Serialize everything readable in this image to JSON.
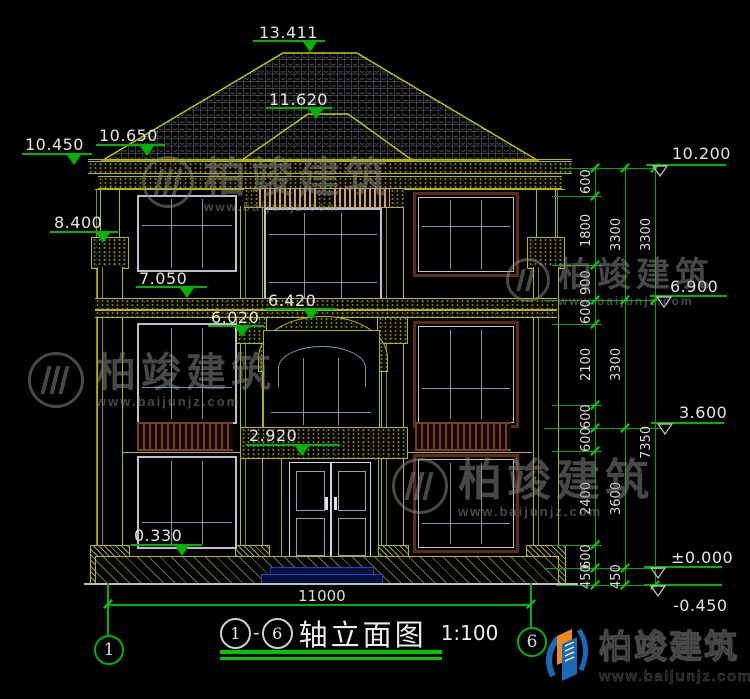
{
  "drawing": {
    "axis_from": "1",
    "axis_to": "6",
    "dash": "-",
    "title_text": "轴立面图",
    "scale": "1:100"
  },
  "axes": {
    "left": "1",
    "right": "6"
  },
  "dimensions": {
    "overall_width": "11000",
    "chain_inner": [
      "600",
      "1800",
      "900",
      "600",
      "2100",
      "600",
      "600",
      "2400",
      "600",
      "450"
    ],
    "chain_mid": [
      "3300",
      "3300",
      "3600",
      "450"
    ],
    "chain_outer": [
      "3300",
      "7350"
    ]
  },
  "elevations": {
    "ridge": "13.411",
    "porch_ridge": "11.620",
    "eave_upper": "10.650",
    "eave_left": "10.450",
    "pilaster_top": "8.400",
    "floor3_sill": "7.050",
    "band_top": "6.420",
    "band_bottom": "6.020",
    "canopy": "2.920",
    "floor1_sill": "0.330",
    "eave_right": "10.200",
    "floor3_right": "6.900",
    "floor2_right": "3.600",
    "ground": "±0.000",
    "base": "-0.450"
  },
  "watermark": {
    "brand": "柏竣建筑",
    "url": "www.baijunjz.com"
  },
  "logo": {
    "brand": "柏竣建筑",
    "url": "www.baijunjz.com"
  },
  "colors": {
    "line_green": "#00b400",
    "line_yellow": "#b8b800",
    "text_white": "#e4e4e4",
    "mullion_blue": "#7b95a9",
    "frame_gray": "#b9c2cb",
    "frame_brown": "#5e2c14",
    "slat_brown": "#7a3f1e",
    "baluster_tan": "#c9a365",
    "step_blue": "#2741c8",
    "logo_blue": "#1a6ab8",
    "logo_orange": "#f08a1d"
  }
}
